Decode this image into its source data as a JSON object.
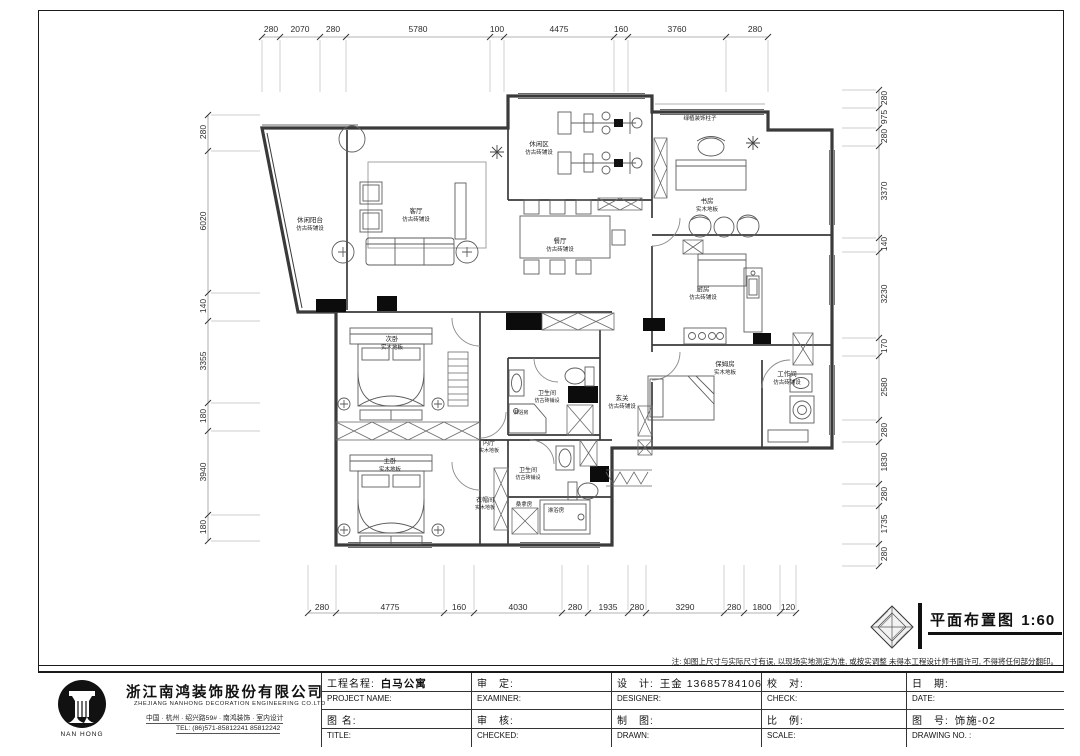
{
  "page": {
    "drawing_title": "平面布置图",
    "drawing_scale": "1:60",
    "note": "注: 如图上尺寸与实际尺寸有误, 以现场实地测定为准, 或按实调整 未得本工程设计师书面许可, 不得将任何部分翻印。"
  },
  "company": {
    "name_cn": "浙江南鸿装饰股份有限公司",
    "name_en": "ZHEJIANG NANHONG DECORATION ENGINEERING CO.LTD",
    "address": "中国 · 杭州 · 绍兴路59# · 南鸿装饰 · 室内设计",
    "tel": "TEL:  (86)571-85812241  85812242",
    "logo_text": "NAN HONG"
  },
  "titleblock": {
    "project_label": "工程名程:",
    "project_value": "白马公寓",
    "project_en": "PROJECT NAME:",
    "name_label": "图 名:",
    "name_en": "TITLE:",
    "examine_label": "审　定:",
    "examine_en": "EXAMINER:",
    "check2_label": "审　核:",
    "check2_en": "CHECKED:",
    "design_label": "设　计:",
    "design_value": "王金  13685784106",
    "design_en": "DESIGNER:",
    "draw_label": "制　图:",
    "draw_en": "DRAWN:",
    "proof_label": "校　对:",
    "proof_en": "CHECK:",
    "ratio_label": "比　例:",
    "ratio_en": "SCALE:",
    "date_label": "日　期:",
    "date_en": "DATE:",
    "no_label": "图　号:",
    "no_value": "饰施-02",
    "no_en": "DRAWING NO. :"
  },
  "dims": {
    "top": [
      "280",
      "2070",
      "280",
      "5780",
      "100",
      "4475",
      "160",
      "3760",
      "280"
    ],
    "left": [
      "280",
      "6020",
      "140",
      "3355",
      "180",
      "3940",
      "180"
    ],
    "right": [
      "280",
      "975",
      "280",
      "3370",
      "140",
      "3230",
      "170",
      "2580",
      "280",
      "1830",
      "280",
      "1735",
      "280"
    ],
    "bottom": [
      "280",
      "4775",
      "160",
      "4030",
      "280",
      "1935",
      "280",
      "3290",
      "280",
      "1800",
      "120"
    ]
  },
  "rooms": {
    "balcony": {
      "name": "休闲阳台",
      "floor": "仿古砖铺设"
    },
    "living": {
      "name": "客厅",
      "floor": "仿古砖铺设"
    },
    "gym": {
      "name": "休闲区",
      "floor": "仿古砖铺设"
    },
    "dining": {
      "name": "餐厅",
      "floor": "仿古砖铺设"
    },
    "study": {
      "name": "书房",
      "floor": "实木地板"
    },
    "kitchen": {
      "name": "厨房",
      "floor": "仿古砖铺设"
    },
    "foyer": {
      "name": "玄关",
      "floor": "仿古砖铺设"
    },
    "nanny": {
      "name": "保姆房",
      "floor": "实木地板"
    },
    "work": {
      "name": "工作间",
      "floor": "仿古砖铺设"
    },
    "bed2": {
      "name": "次卧",
      "floor": "实木地板"
    },
    "master": {
      "name": "主卧",
      "floor": "实木地板"
    },
    "bath1": {
      "name": "卫生间",
      "floor": "仿古砖铺设"
    },
    "bath2": {
      "name": "卫生间",
      "floor": "仿古砖铺设"
    },
    "hall": {
      "name": "内厅",
      "floor": "实木地板"
    },
    "closet": {
      "name": "衣帽间",
      "floor": "实木地板"
    },
    "sauna": {
      "name": "桑拿房"
    },
    "shower1": {
      "name": "淋浴房"
    },
    "shower2": {
      "name": "淋浴房"
    },
    "balcony_note": {
      "name": "绿植装饰柱子"
    }
  }
}
